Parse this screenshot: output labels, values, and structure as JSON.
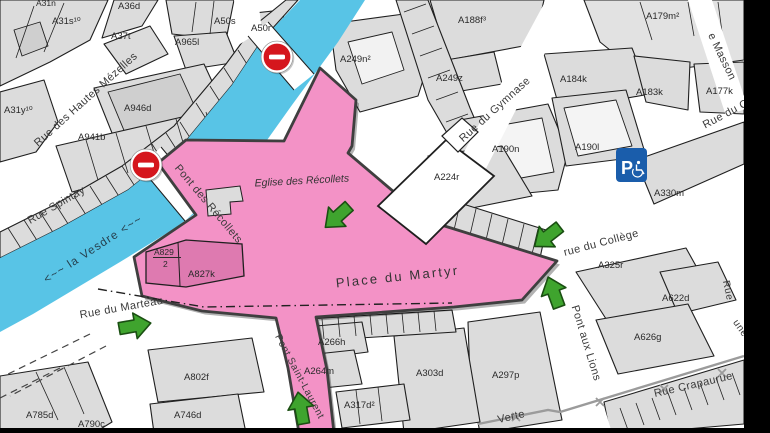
{
  "map": {
    "streets": {
      "spintay": "Rue Spintay",
      "hautes_mezelles": "Rue des Hautes Mézelles",
      "gymnase": "Rue du Gymnase",
      "college": "rue du Collège",
      "rue_du_c": "Rue du C",
      "masson": "e Masson",
      "marteau": "Rue du Marteau",
      "pont_recollets": "Pont des Récollets",
      "pont_st_laurent": "Pont Saint-Laurent",
      "pont_aux_lions": "Pont aux Lions",
      "verte": "Verte",
      "crapaurue": "Rue Crapaurue",
      "rue_partial_1": "Rue",
      "rue_partial_2": "une"
    },
    "places": {
      "place_martyr": "Place du Martyr",
      "eglise": "Eglise des Récollets",
      "vesdre": "<~~ la Vesdre <~~"
    },
    "parcels": {
      "a31n": "A31n",
      "a31s": "A31s¹⁰",
      "a36d": "A36d",
      "a37t": "A37t",
      "a31y": "A31y¹⁰",
      "a50s": "A50s",
      "a50r": "A50r",
      "a965l": "A965l",
      "a946d": "A946d",
      "a941b": "A941b",
      "a249n": "A249n²",
      "a249z": "A249z",
      "a188f": "A188f³",
      "a179m": "A179m²",
      "a184k": "A184k",
      "a183k": "A183k",
      "a177k": "A177k",
      "a190n": "A190n",
      "a190l": "A190l",
      "a224r": "A224r",
      "a330m": "A330m",
      "a325r": "A325r",
      "a622d": "A622d",
      "a626g": "A626g",
      "a297p": "A297p",
      "a303d": "A303d",
      "a317d": "A317d²",
      "a266h": "A266h",
      "a264m": "A264m",
      "a802f": "A802f",
      "a746d": "A746d",
      "a785d": "A785d",
      "a790c": "A790c",
      "a829": "A829",
      "a829_den": "2",
      "a827k": "A827k"
    },
    "icons": {
      "no_entry": "no-entry-icon",
      "access_arrow": "green-access-arrow-icon",
      "parking": "disabled-parking-icon",
      "parking_letter": "P"
    },
    "colors": {
      "river": "#58c4e6",
      "zone_pink": "#f392c6",
      "zone_pink_dark": "#de7ab0",
      "zone_border": "#3f3f3f",
      "building": "#dcdcdc",
      "building_light": "#f3f3f3",
      "outline": "#1f1f1f",
      "no_entry_red": "#d5161d",
      "arrow_green": "#3fa42e",
      "arrow_green_dark": "#1a4f12",
      "parking_blue": "#1a5dab",
      "boundary_gray": "#9b9b9b"
    }
  }
}
